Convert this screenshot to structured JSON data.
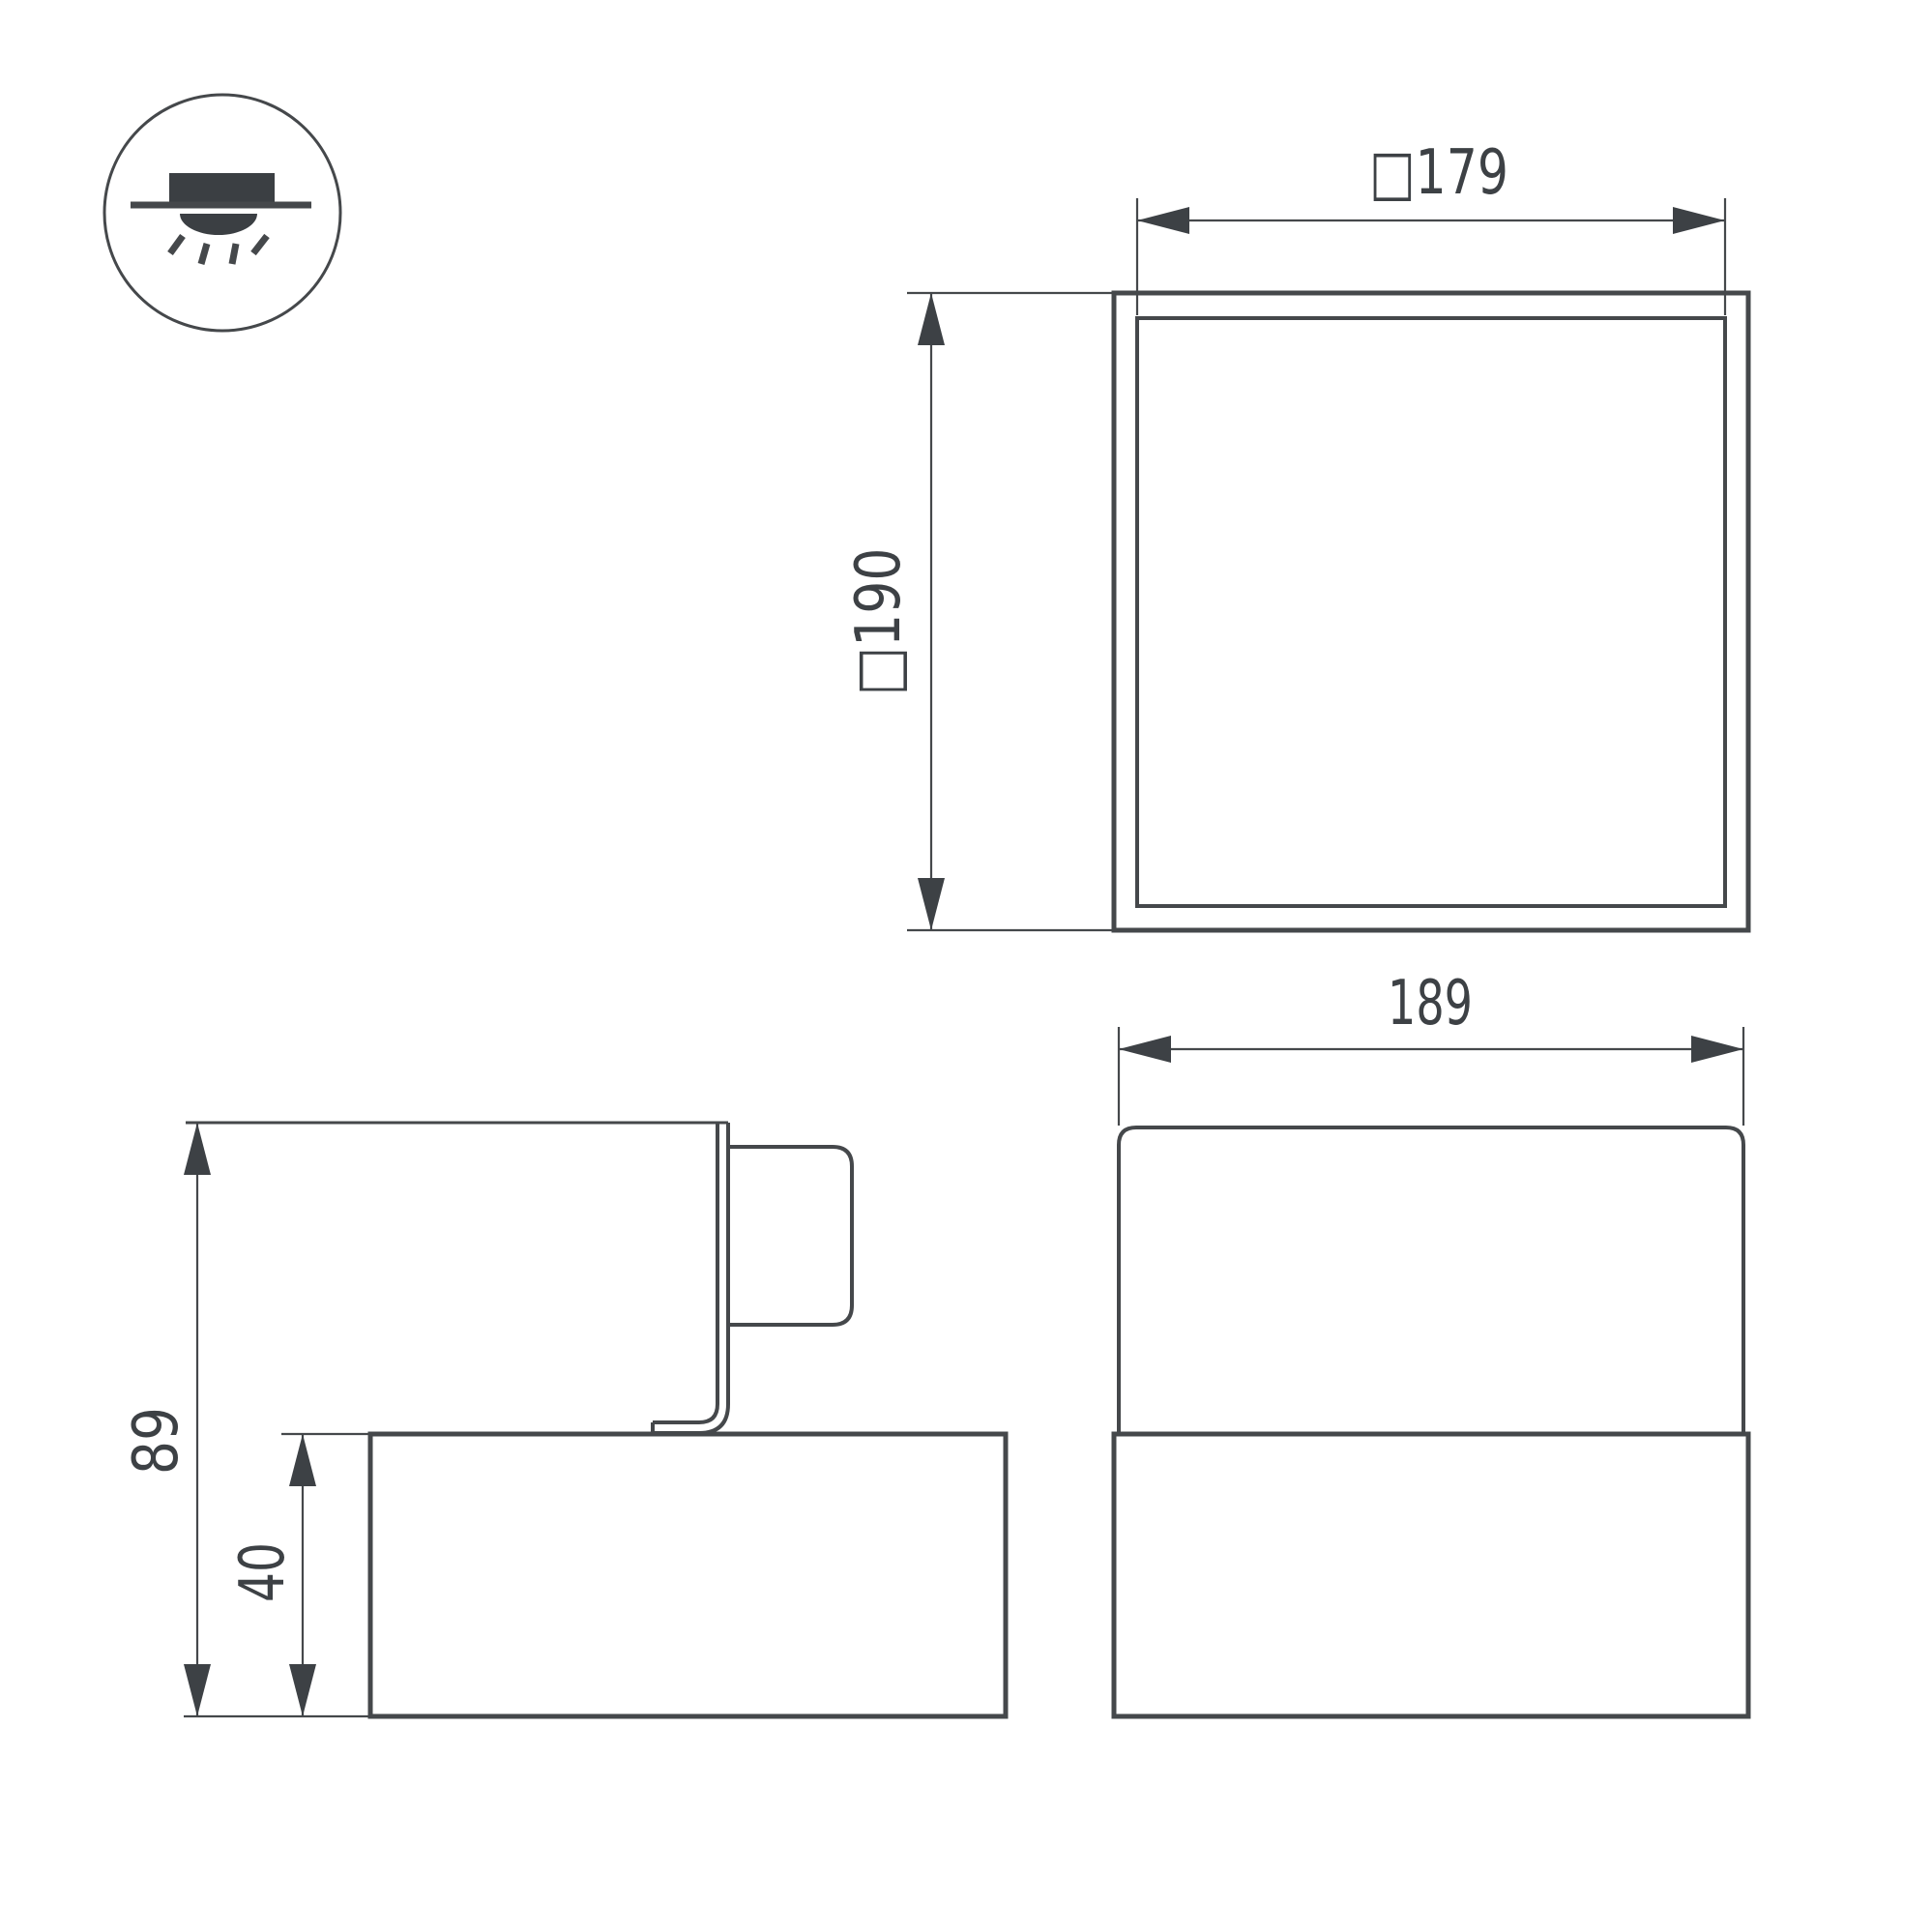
{
  "theme": {
    "background": "#ffffff",
    "line_color": "#45484b",
    "dark_fill": "#3b3f43",
    "text_color": "#3d4145"
  },
  "legend_icon": {
    "name": "surface-mounted-downlight-icon",
    "meaning": "ceiling surface mount, light directed downward"
  },
  "views": {
    "top": {
      "width_dim": {
        "label": "□179",
        "value_mm": 179,
        "orientation": "horizontal"
      },
      "height_dim": {
        "label": "□190",
        "value_mm": 190,
        "orientation": "vertical"
      }
    },
    "side": {
      "total_height_dim": {
        "label": "89",
        "value_mm": 89,
        "orientation": "vertical"
      },
      "body_height_dim": {
        "label": "40",
        "value_mm": 40,
        "orientation": "vertical"
      }
    },
    "front": {
      "width_dim": {
        "label": "189",
        "value_mm": 189,
        "orientation": "horizontal"
      }
    }
  }
}
